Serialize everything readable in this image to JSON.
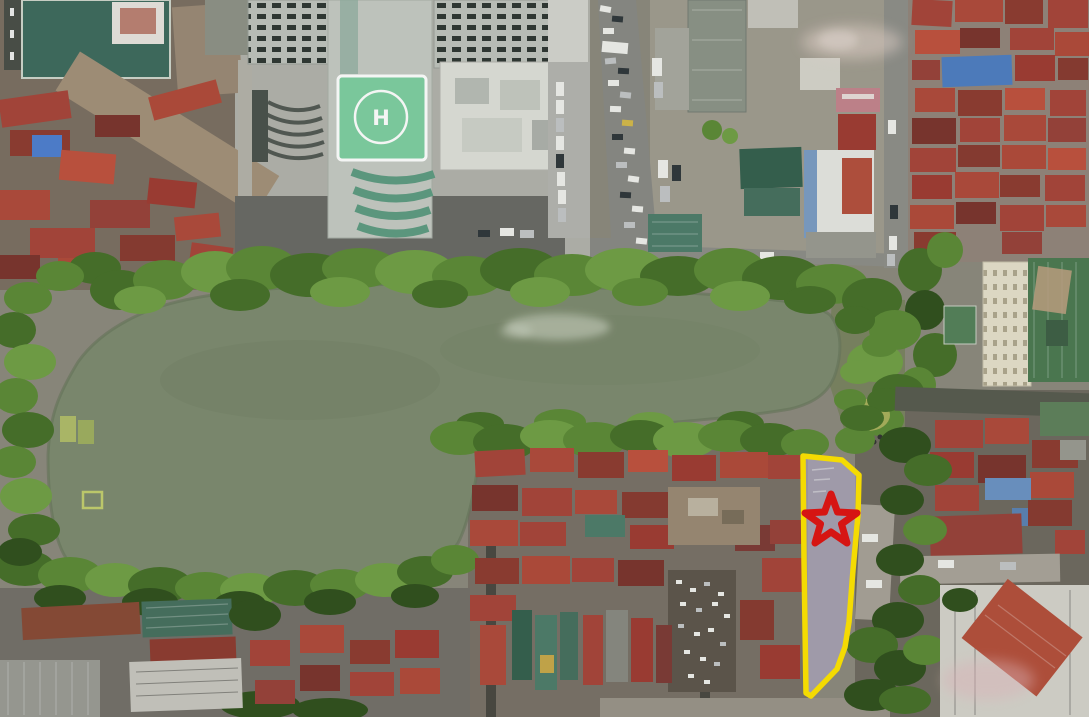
{
  "scene": {
    "type": "aerial-drone-photo",
    "helipad_label": "H"
  },
  "annotation": {
    "marker_icon": "star-icon",
    "highlight_shape": "land-parcel-polygon"
  },
  "colors": {
    "lake_water": "#7e8b70",
    "lake_rim": "#68765c",
    "helipad_pad": "#7fcfa2",
    "parcel_fill": "#b7aecf",
    "parcel_outline": "#ffe400",
    "star_outline": "#e01312"
  }
}
